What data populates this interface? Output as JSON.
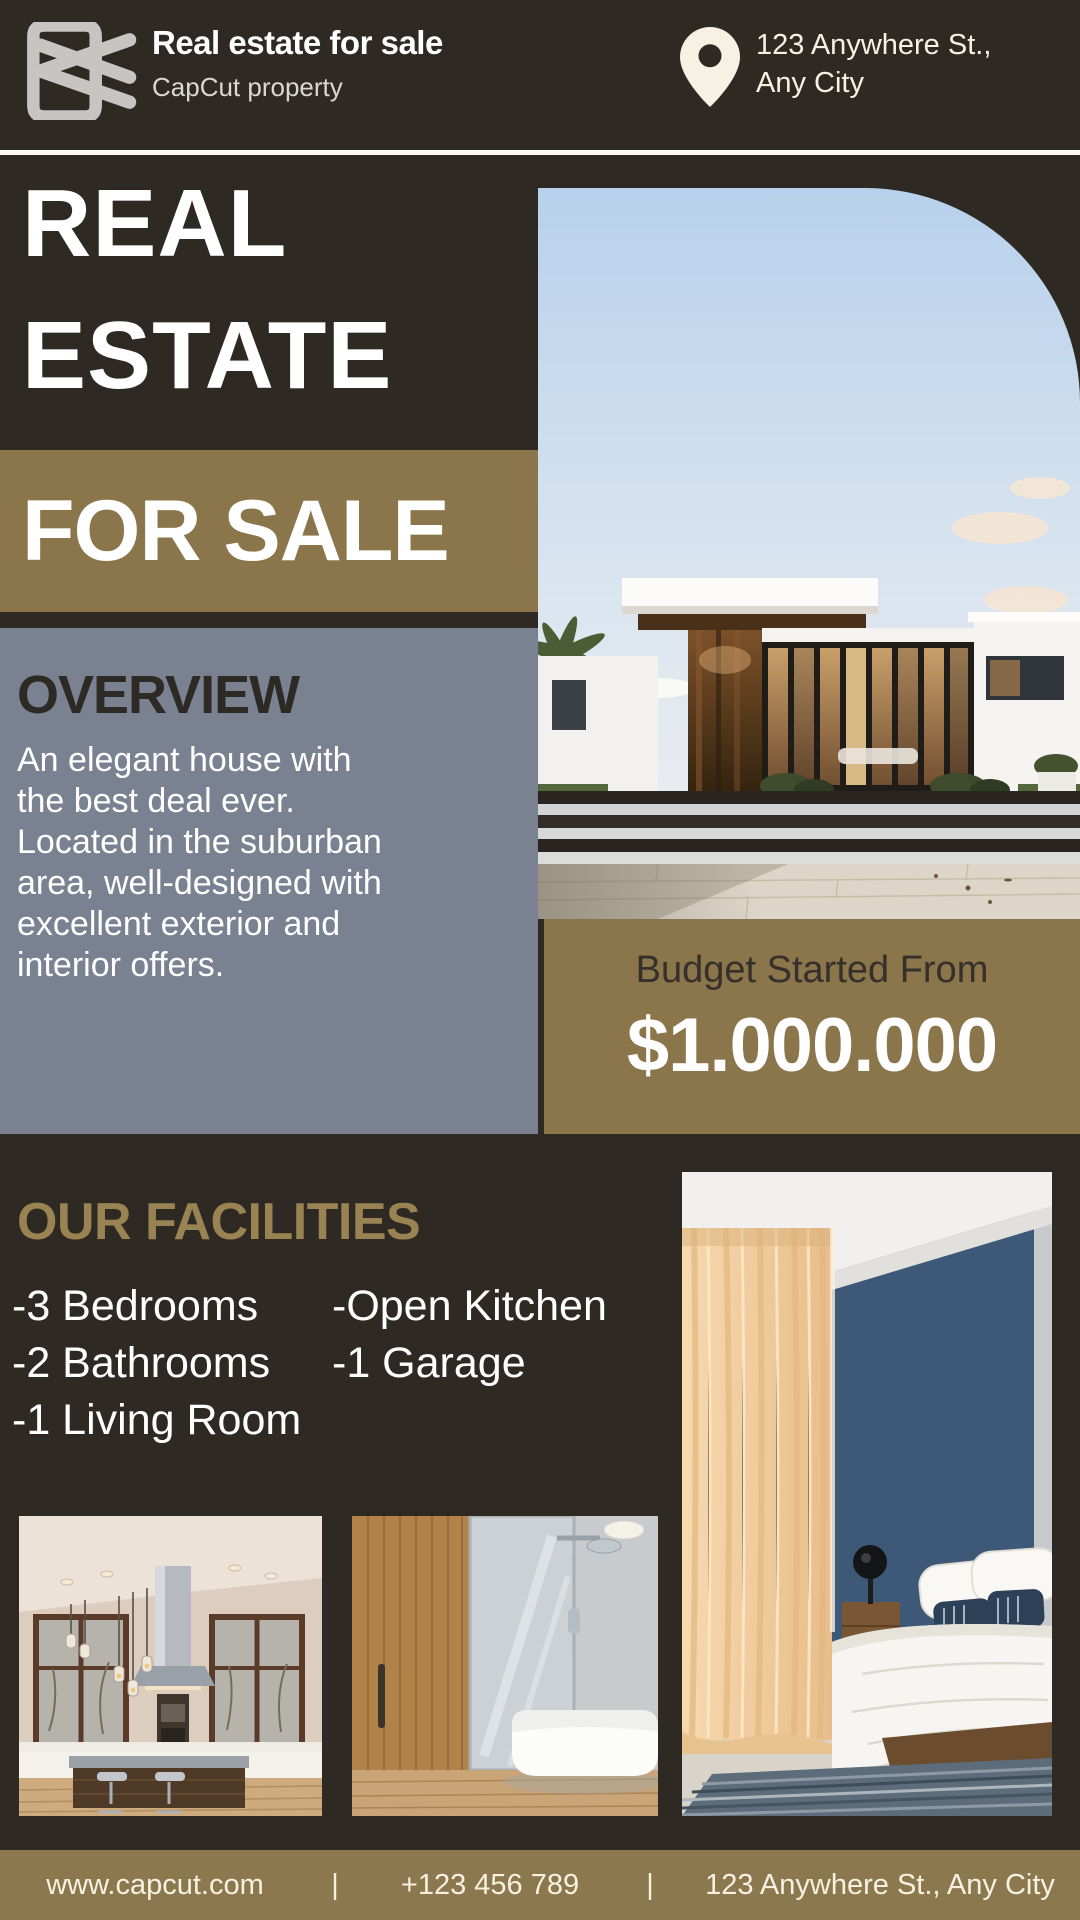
{
  "colors": {
    "background": "#2E2A23",
    "olive_band": "#8B754B",
    "footer_olive": "#8C784E",
    "slate_gray_panel": "#7A8190",
    "gold_heading": "#9A8352",
    "cream_text": "#F6F1E2",
    "dark_text": "#2D2A25",
    "logo_gray": "#C7C5C2"
  },
  "header": {
    "brand_title": "Real estate for sale",
    "brand_subtitle": "CapCut property",
    "logo_icon": "capcut-logo",
    "location_icon": "location-pin",
    "address": "123 Anywhere St.,\nAny City"
  },
  "hero": {
    "title": "REAL\nESTATE",
    "banner": "FOR SALE"
  },
  "overview": {
    "heading": "OVERVIEW",
    "body": "An elegant house with\nthe best deal ever.\nLocated in the suburban\narea, well-designed with\nexcellent exterior and\ninterior offers."
  },
  "budget": {
    "label": "Budget Started From",
    "price": "$1.000.000"
  },
  "facilities": {
    "heading": "OUR FACILITIES",
    "column1": [
      "-3 Bedrooms",
      "-2 Bathrooms",
      "-1 Living Room"
    ],
    "column2": [
      "-Open Kitchen",
      "-1 Garage"
    ]
  },
  "photos": {
    "hero": "modern-house-exterior",
    "kitchen": "kitchen-interior",
    "bathroom": "bathroom-interior",
    "bedroom": "bedroom-interior"
  },
  "footer": {
    "website": "www.capcut.com",
    "separator": "|",
    "phone": "+123 456 789",
    "address": "123 Anywhere St., Any City"
  }
}
